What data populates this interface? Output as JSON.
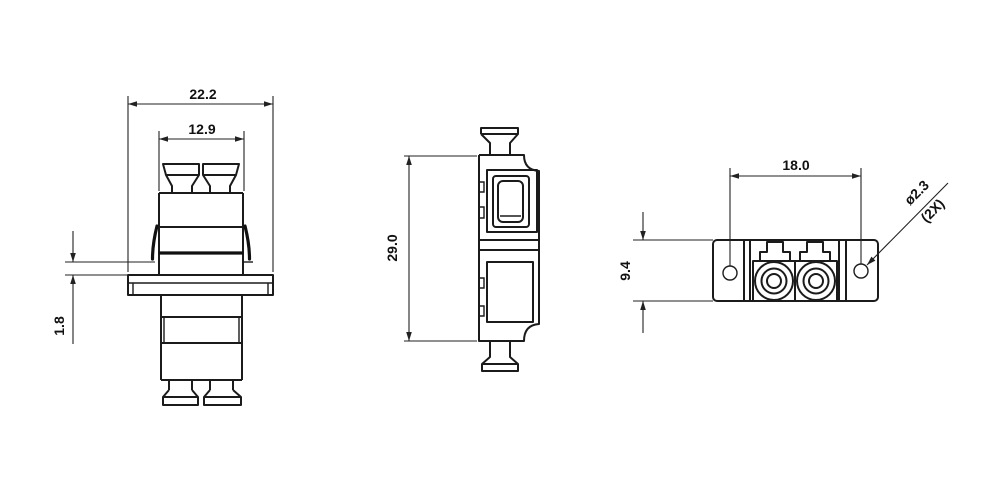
{
  "drawing": {
    "kind": "technical-drawing",
    "subject": "duplex fiber adapter, three orthographic views",
    "background_color": "#ffffff",
    "line_color": "#1b1b1b",
    "views": {
      "front": {
        "title": "front view",
        "dims": {
          "flange_width": "22.2",
          "body_width": "12.9",
          "panel_gap": "1.8"
        }
      },
      "side": {
        "title": "side view",
        "dims": {
          "body_height": "29.0"
        }
      },
      "top": {
        "title": "top view",
        "dims": {
          "hole_spacing": "18.0",
          "flange_height": "9.4",
          "hole_diameter": "ø2.3",
          "hole_quantity": "(2X)"
        }
      }
    }
  }
}
